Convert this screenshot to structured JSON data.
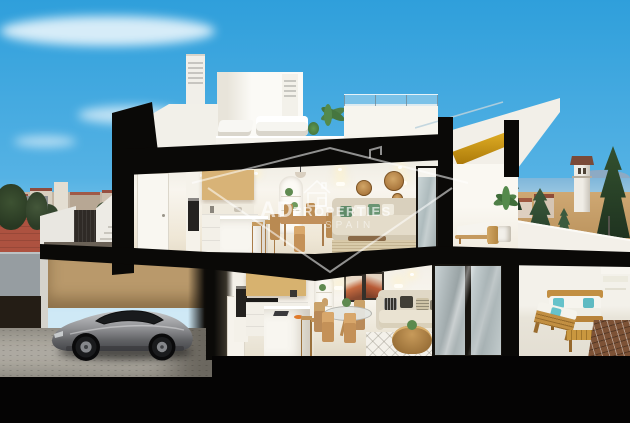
{
  "image_type": "3d-architectural-cutaway-render",
  "watermark": {
    "brand_primary": "AD",
    "brand_secondary": "PROPERTIES",
    "tagline": "SPAIN",
    "logo_icon": "house-outline-icon",
    "text_color": "#ffffff",
    "opacity": 0.62
  },
  "palette": {
    "sky_top": "#2f9fdb",
    "sky_horizon": "#a9d9f1",
    "section_cut_black": "#0a0907",
    "wall_white": "#f4f2ec",
    "wood_cabinet": "#d8b377",
    "stair_gold": "#d9a21b",
    "garage_fence_wood": "#b9996b",
    "car_silver": "#a6a7aa",
    "cushion_green": "#5f8a68",
    "cushion_teal": "#66c2ca",
    "street_terracotta": "#ad5240",
    "sea": "#7fb6da",
    "sand": "#c49a6a",
    "terrace_gravel": "#7d5236",
    "outdoor_wood": "#c28f42"
  },
  "scene": {
    "floors": [
      {
        "name": "roof",
        "features": [
          "roof terrace with white loungers",
          "two louvred chimneys",
          "glass railing",
          "sectioned gold staircase"
        ]
      },
      {
        "name": "upper-floor",
        "features": [
          "kitchen with oak cabinets",
          "dining table for four",
          "living room with green cushions and rattan wall decor",
          "terrace with sun lounger and palm"
        ]
      },
      {
        "name": "ground-floor",
        "features": [
          "garage with silver sports car",
          "kitchen with island and stools",
          "living-dining room with round glass table",
          "terrace with wooden lounge set and teal pillows"
        ]
      }
    ],
    "background": [
      "city skyline with red roofs",
      "sea with distant mountains",
      "watchtower",
      "conifer trees",
      "terracotta street"
    ]
  }
}
